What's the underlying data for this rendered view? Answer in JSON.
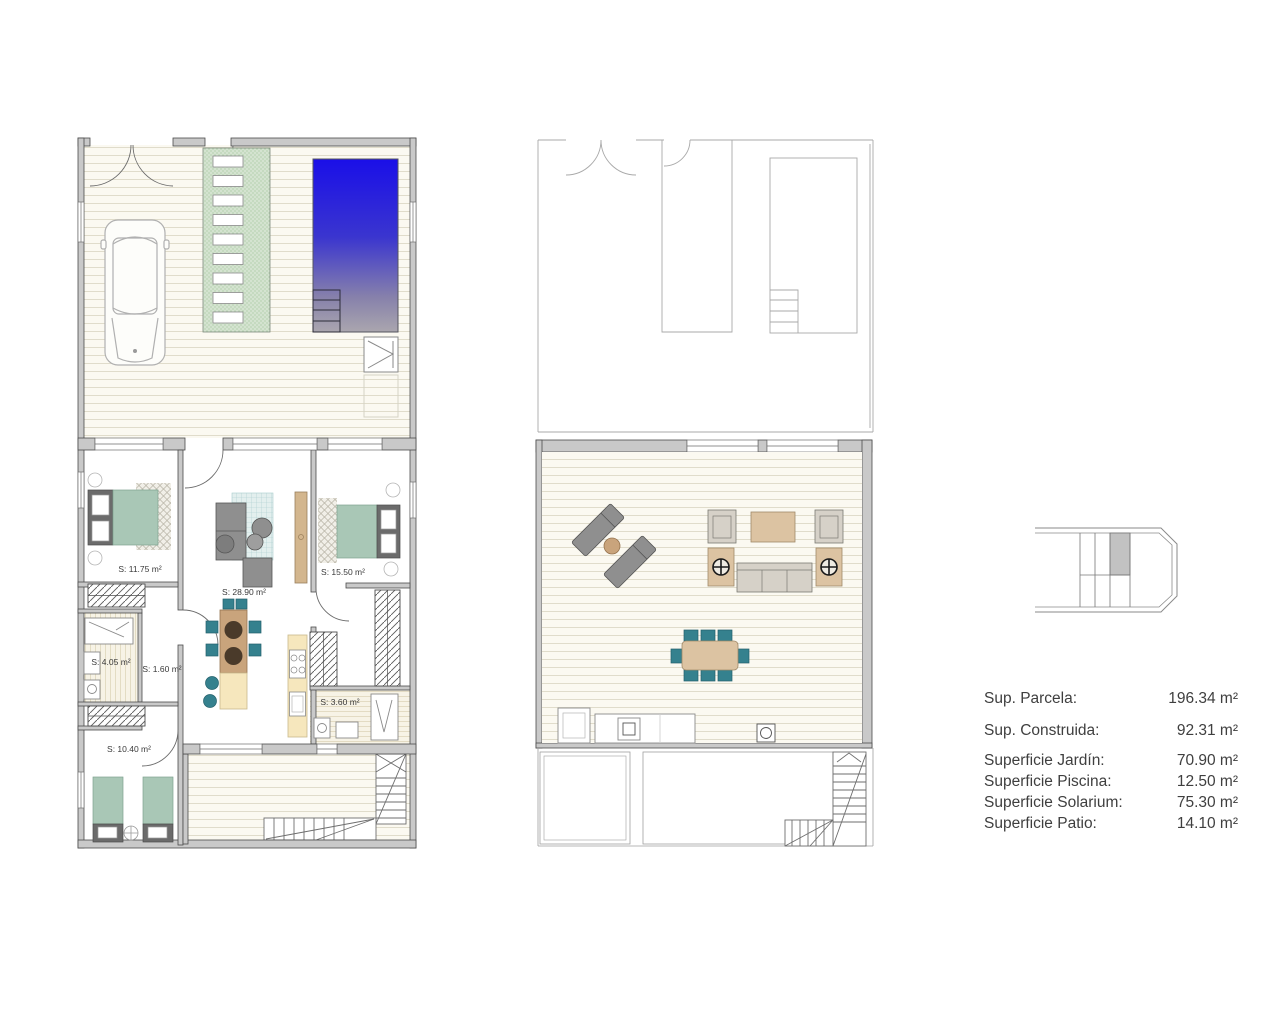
{
  "document": {
    "type": "floor-plan-sheet",
    "background": "#ffffff"
  },
  "ground_floor": {
    "room_labels": {
      "bedroom_left": "S: 11.75 m²",
      "living_kitchen": "S: 28.90 m²",
      "bedroom_right": "S: 15.50 m²",
      "bathroom_left": "S: 4.05 m²",
      "hall": "S: 1.60 m²",
      "bathroom_right": "S: 3.60 m²",
      "bedroom_bottom": "S: 10.40 m²"
    }
  },
  "legend": {
    "rows": [
      {
        "label": "Sup. Parcela:",
        "value": "196.34 m²"
      },
      {
        "label": "Sup. Construida:",
        "value": "92.31 m²"
      },
      {
        "label": "Superficie Jardín:",
        "value": "70.90 m²"
      },
      {
        "label": "Superficie Piscina:",
        "value": "12.50 m²"
      },
      {
        "label": "Superficie Solarium:",
        "value": "75.30 m²"
      },
      {
        "label": "Superficie Patio:",
        "value": "14.10 m²"
      }
    ]
  },
  "colors": {
    "wall_fill": "#c9c9c9",
    "wall_stroke": "#4c4c4c",
    "deck_background": "#fbf9f1",
    "deck_line": "#e0dccb",
    "garden_green": "#d4e3d0",
    "pool_blue_top": "#1a0fe8",
    "pool_gray_bottom": "#aaa6ae",
    "bed_green": "#a9c7b6",
    "furniture_gray": "#8f8f8f",
    "accent_teal": "#35818e",
    "wood_tan": "#c9a47c",
    "kitchen_cream": "#f6e7bd",
    "rug_blue": "#e3efee",
    "keyplan_shaded_unit": "#c2c2c2"
  }
}
